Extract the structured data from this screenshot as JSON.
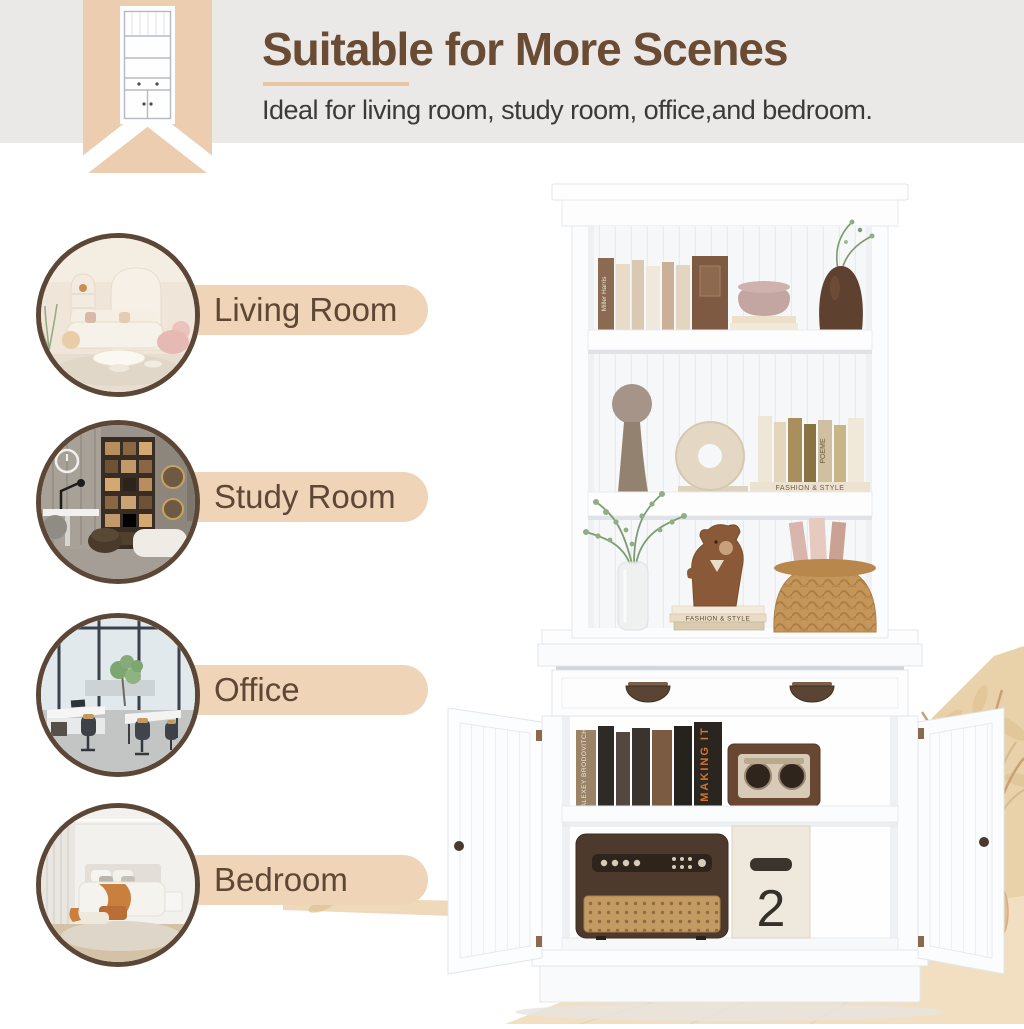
{
  "header": {
    "title": "Suitable for More Scenes",
    "subtitle": "Ideal for living room, study room, office,and bedroom."
  },
  "scenes": [
    {
      "label": "Living Room"
    },
    {
      "label": "Study Room"
    },
    {
      "label": "Office"
    },
    {
      "label": "Bedroom"
    }
  ],
  "product": {
    "description": "White bookshelf hutch with open shelves, drawer and two-door storage cabinet",
    "decor_text": {
      "book_stack_spine": "FASHION & STYLE",
      "book_spine_top_shelf": "Miller Harris",
      "book_spine_middle_shelf": "POEME",
      "cabinet_book_spine": "MAKING IT",
      "cabinet_book_spine_left": "ALEXEY BRODOVITCH",
      "storage_box_number": "2"
    }
  },
  "colors": {
    "band_gray": "#ebe9e8",
    "ribbon_tan": "#eccdaf",
    "pill_tan": "#efd4b8",
    "title_brown": "#6a4b33",
    "label_brown": "#5f4736",
    "circle_border": "#5c4737",
    "underline_tan": "#e7c7a2",
    "floor_tan": "#f2dfc1",
    "wall_tan": "#e9d1aa"
  }
}
